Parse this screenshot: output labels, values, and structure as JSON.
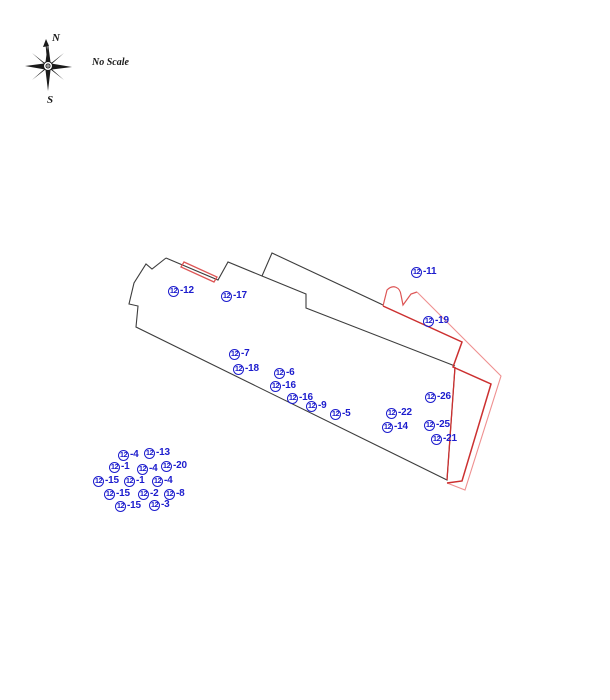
{
  "compass": {
    "north_label": "N",
    "south_label": "S"
  },
  "scale_note": "No Scale",
  "colors": {
    "label_blue": "#1c1ccd",
    "outline_black": "#3d3d3d",
    "compass_dark": "#1a1a1a",
    "red_dark": "#cc3030",
    "red_mid": "#dd5555",
    "red_light": "#ef9090"
  },
  "markers": {
    "unit": "12",
    "items": [
      {
        "suffix": "-11",
        "x": 411,
        "y": 266
      },
      {
        "suffix": "-12",
        "x": 168,
        "y": 285
      },
      {
        "suffix": "-17",
        "x": 221,
        "y": 290
      },
      {
        "suffix": "-19",
        "x": 423,
        "y": 315
      },
      {
        "suffix": "-7",
        "x": 229,
        "y": 348
      },
      {
        "suffix": "-18",
        "x": 233,
        "y": 363
      },
      {
        "suffix": "-6",
        "x": 274,
        "y": 367
      },
      {
        "suffix": "-16",
        "x": 270,
        "y": 380
      },
      {
        "suffix": "-16",
        "x": 287,
        "y": 392
      },
      {
        "suffix": "-9",
        "x": 306,
        "y": 400
      },
      {
        "suffix": "-5",
        "x": 330,
        "y": 408
      },
      {
        "suffix": "-26",
        "x": 425,
        "y": 391
      },
      {
        "suffix": "-22",
        "x": 386,
        "y": 407
      },
      {
        "suffix": "-14",
        "x": 382,
        "y": 421
      },
      {
        "suffix": "-25",
        "x": 424,
        "y": 419
      },
      {
        "suffix": "-21",
        "x": 431,
        "y": 433
      },
      {
        "suffix": "-4",
        "x": 118,
        "y": 449
      },
      {
        "suffix": "-13",
        "x": 144,
        "y": 447
      },
      {
        "suffix": "-1",
        "x": 109,
        "y": 461
      },
      {
        "suffix": "-4",
        "x": 137,
        "y": 463
      },
      {
        "suffix": "-20",
        "x": 161,
        "y": 460
      },
      {
        "suffix": "-15",
        "x": 93,
        "y": 475
      },
      {
        "suffix": "-1",
        "x": 124,
        "y": 475
      },
      {
        "suffix": "-4",
        "x": 152,
        "y": 475
      },
      {
        "suffix": "-15",
        "x": 104,
        "y": 488
      },
      {
        "suffix": "-2",
        "x": 138,
        "y": 488
      },
      {
        "suffix": "-8",
        "x": 164,
        "y": 488
      },
      {
        "suffix": "-15",
        "x": 115,
        "y": 500
      },
      {
        "suffix": "-3",
        "x": 149,
        "y": 499
      }
    ]
  }
}
